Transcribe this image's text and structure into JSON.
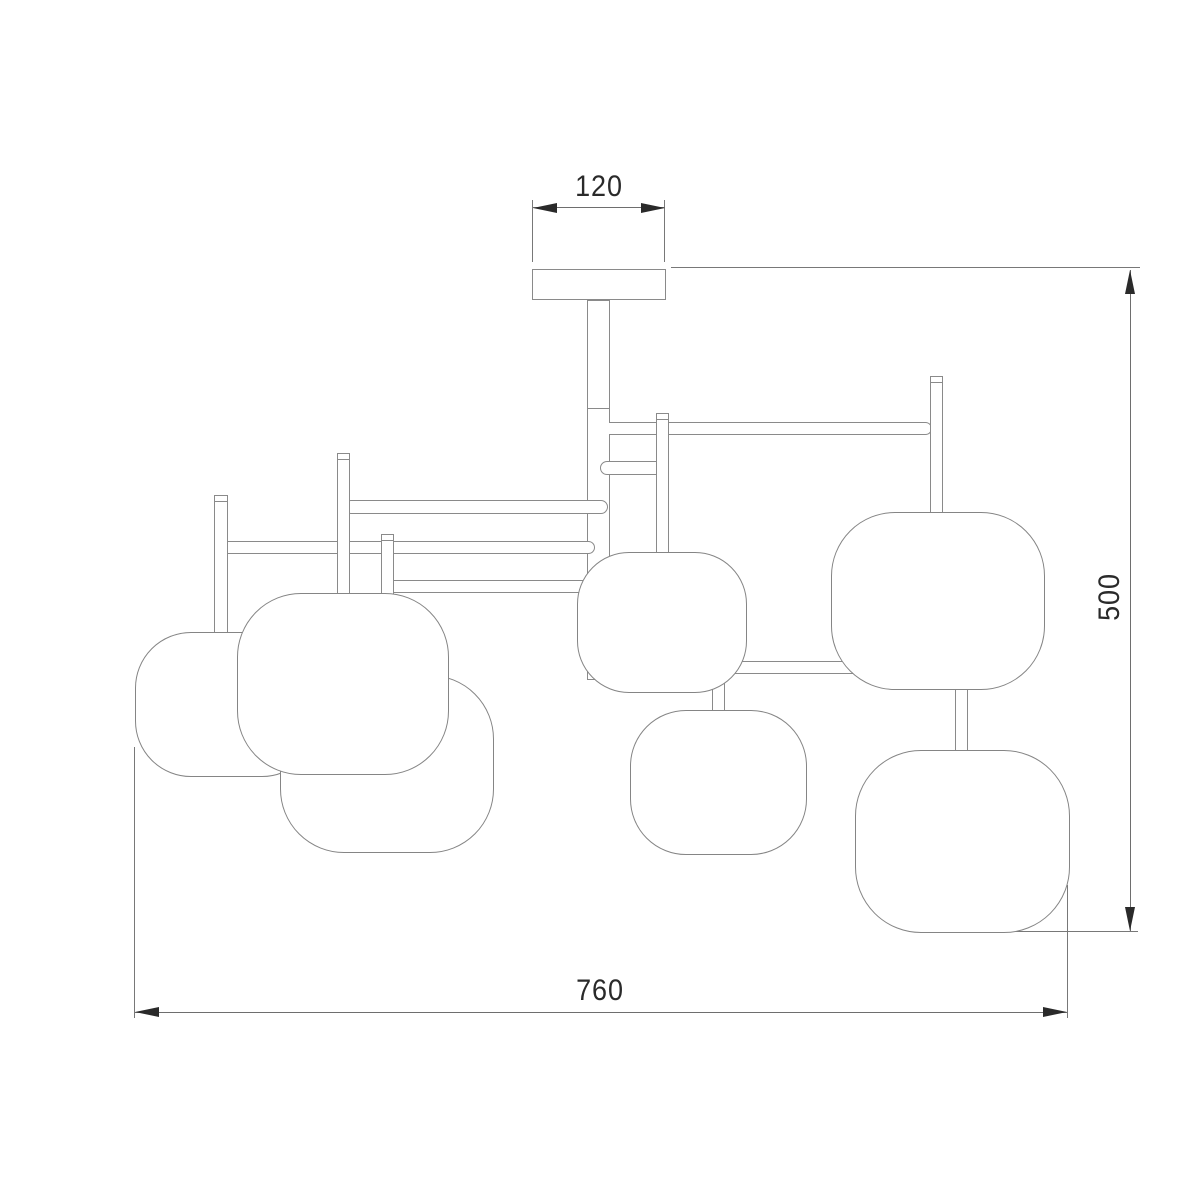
{
  "drawing": {
    "title": "ceiling chandelier technical elevation, 7 shades",
    "labels": {
      "canopy_width": "120",
      "fixture_height": "500",
      "fixture_width": "760"
    },
    "colors": {
      "background": "#ffffff",
      "fixture_outline": "#8a8a8a",
      "dimension_line": "#6e6e6e",
      "arrow_and_text": "#2a2a2a"
    },
    "shade_count": 7
  }
}
